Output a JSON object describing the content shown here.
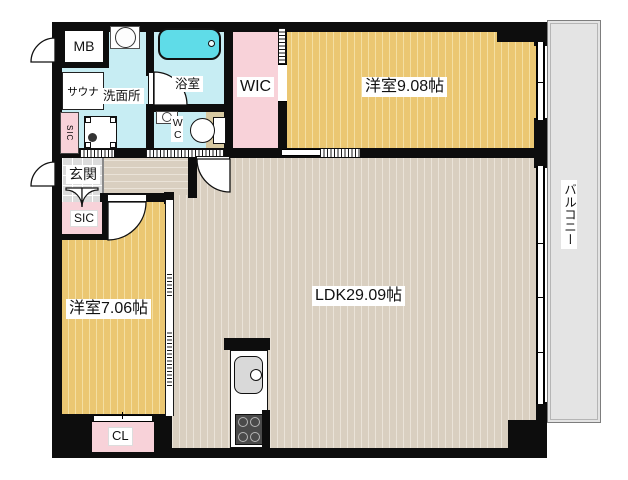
{
  "floorplan": {
    "rooms": {
      "bedroom_top": {
        "label": "洋室9.08帖"
      },
      "ldk": {
        "label": "LDK29.09帖"
      },
      "bedroom_left": {
        "label": "洋室7.06帖"
      },
      "balcony": {
        "label": "バルコニー"
      },
      "wic": {
        "label": "WIC"
      },
      "entrance": {
        "label": "玄関"
      },
      "sic_entrance": {
        "label": "SIC"
      },
      "sic_side": {
        "label": "SIC"
      },
      "meter_box": {
        "label": "MB"
      },
      "sauna": {
        "label": "サウナ"
      },
      "washroom": {
        "label": "洗面所"
      },
      "bathroom": {
        "label": "浴室"
      },
      "wc": {
        "label": "WC"
      },
      "closet_cl": {
        "label": "CL"
      }
    },
    "colors": {
      "wall": "#0d0d0d",
      "wood_yellow": "#ebc772",
      "wood_yellow_stripe": "#f4dfa2",
      "wood_beige": "#d9cfc0",
      "wood_beige_stripe": "#eae3d8",
      "water_cyan": "#c7edf3",
      "tub_cyan": "#5fdce8",
      "closet_pink": "#f8d2d9",
      "tile_gray": "#dcdcdc",
      "balcony_gray": "#e4e4e4",
      "counter_tan": "#d8caa2"
    }
  }
}
